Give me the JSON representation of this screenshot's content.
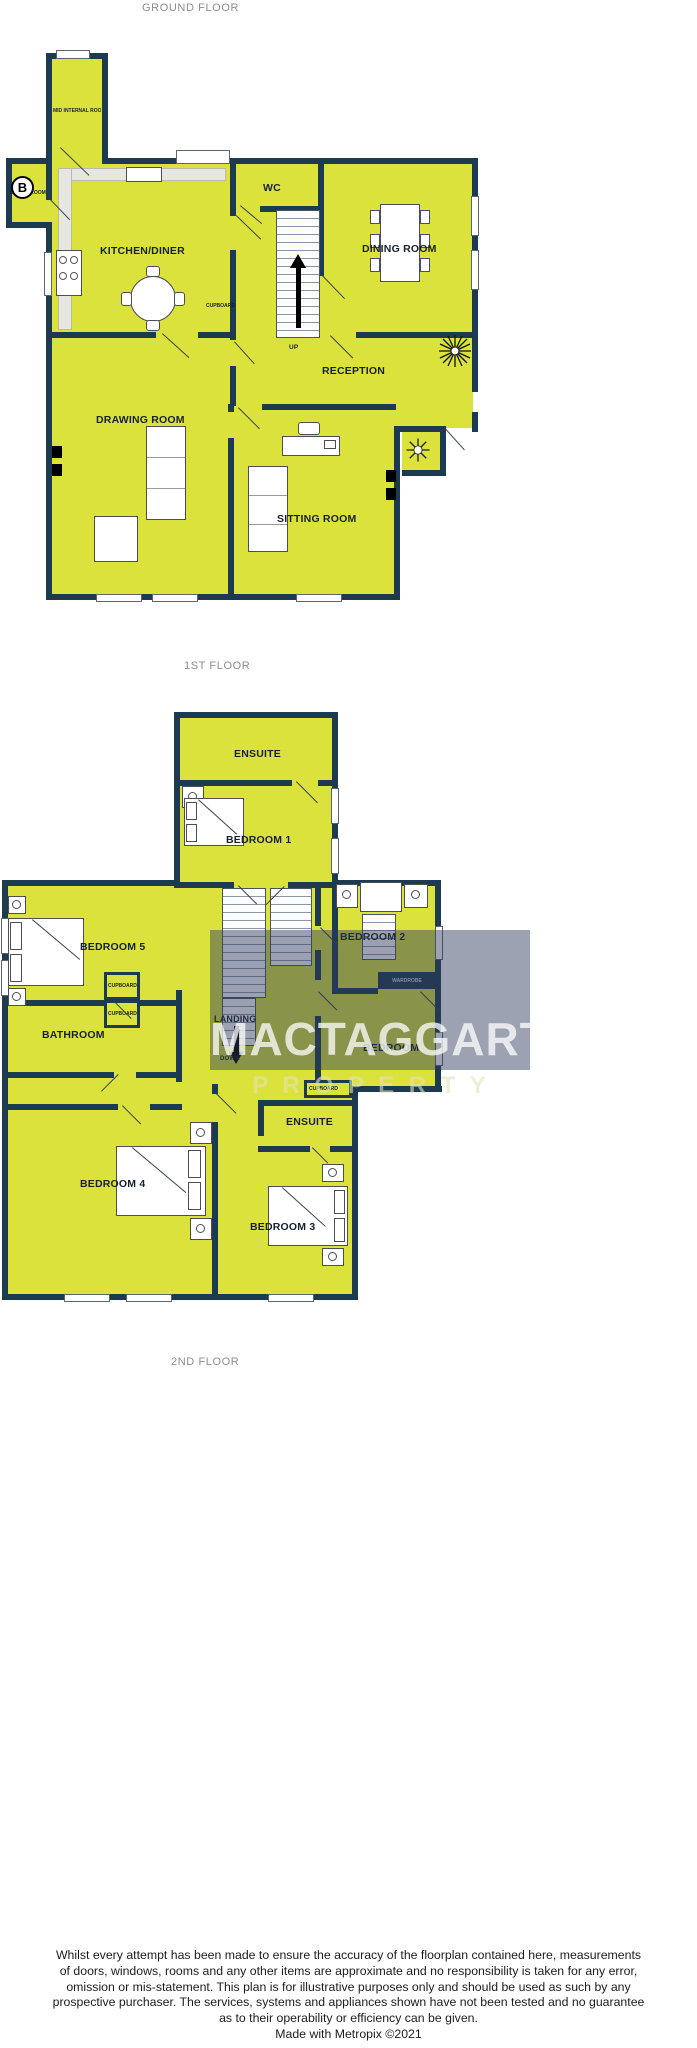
{
  "colors": {
    "wall": "#1c3a50",
    "room": "#dce23c",
    "counter": "#e7e7e2",
    "caption": "#8d8d8d",
    "overlay": "rgba(45,58,90,0.47)"
  },
  "captions": {
    "ground_floor": "GROUND FLOOR",
    "first_floor": "1ST FLOOR",
    "second_floor": "2ND FLOOR"
  },
  "ground": {
    "mid_internal_room": "MID INTERNAL ROOM",
    "boiler_room": "BOILER ROOM",
    "boiler_symbol": "B",
    "kitchen_diner": "KITCHEN/DINER",
    "wc": "WC",
    "dining_room": "DINING ROOM",
    "up": "UP",
    "reception": "RECEPTION",
    "cupboard": "CUPBOARD",
    "drawing_room": "DRAWING ROOM",
    "sitting_room": "SITTING ROOM"
  },
  "first": {
    "ensuite_top": "ENSUITE",
    "bedroom1": "BEDROOM 1",
    "bedroom5": "BEDROOM 5",
    "bedroom2": "BEDROOM 2",
    "wardrobe": "WARDROBE",
    "landing": "LANDING",
    "down": "DOWN",
    "bathroom": "BATHROOM",
    "cupboard": "CUPBOARD",
    "bedroom": "BEDROOM",
    "ensuite_bottom": "ENSUITE",
    "bedroom4": "BEDROOM 4",
    "bedroom3": "BEDROOM 3"
  },
  "watermark": {
    "name": "MACTAGGART",
    "subtitle": "P R O P E R T Y"
  },
  "footer": {
    "line1": "Whilst every attempt has been made to ensure the accuracy of the floorplan contained here, measurements",
    "line2": "of doors, windows, rooms and any other items are approximate and no responsibility is taken for any error,",
    "line3": "omission or mis-statement. This plan is for illustrative purposes only and should be used as such by any",
    "line4": "prospective purchaser. The services, systems and appliances shown have not been tested and no guarantee",
    "line5": "as to their operability or efficiency can be given.",
    "credit": "Made with Metropix ©2021"
  }
}
